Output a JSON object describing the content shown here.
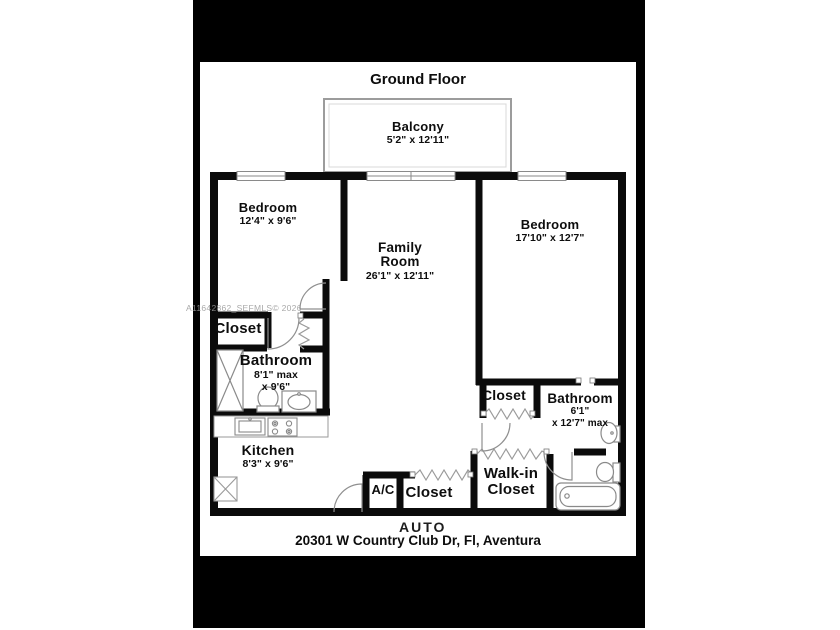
{
  "plan": {
    "title": "Ground Floor",
    "address": "20301 W Country Club Dr, Fl, Aventura",
    "rooms": {
      "balcony": {
        "name": "Balcony",
        "dims": "5'2\" x 12'11\""
      },
      "bedroom_left": {
        "name": "Bedroom",
        "dims": "12'4\" x 9'6\""
      },
      "family_room": {
        "line1": "Family",
        "line2": "Room",
        "dims": "26'1\" x 12'11\""
      },
      "bedroom_right": {
        "name": "Bedroom",
        "dims": "17'10\" x 12'7\""
      },
      "closet_left": {
        "name": "Closet"
      },
      "bathroom_left": {
        "name": "Bathroom",
        "d1": "8'1\" max",
        "d2": "x 9'6\""
      },
      "kitchen": {
        "name": "Kitchen",
        "dims": "8'3\" x 9'6\""
      },
      "ac": {
        "name": "A/C"
      },
      "closet_hall": {
        "name": "Closet"
      },
      "walkin_closet": {
        "line1": "Walk-in",
        "line2": "Closet"
      },
      "closet_right": {
        "name": "Closet"
      },
      "bathroom_right": {
        "name": "Bathroom",
        "d1": "6'1\"",
        "d2": "x 12'7\" max"
      }
    }
  },
  "watermarks": {
    "mls": "A11642862_SEFMLS© 2026",
    "auto": "AUTO"
  },
  "colors": {
    "wall": "#0b0b0b",
    "thin_line": "#8a8a8a",
    "canvas": "#000000",
    "paper": "#ffffff"
  }
}
